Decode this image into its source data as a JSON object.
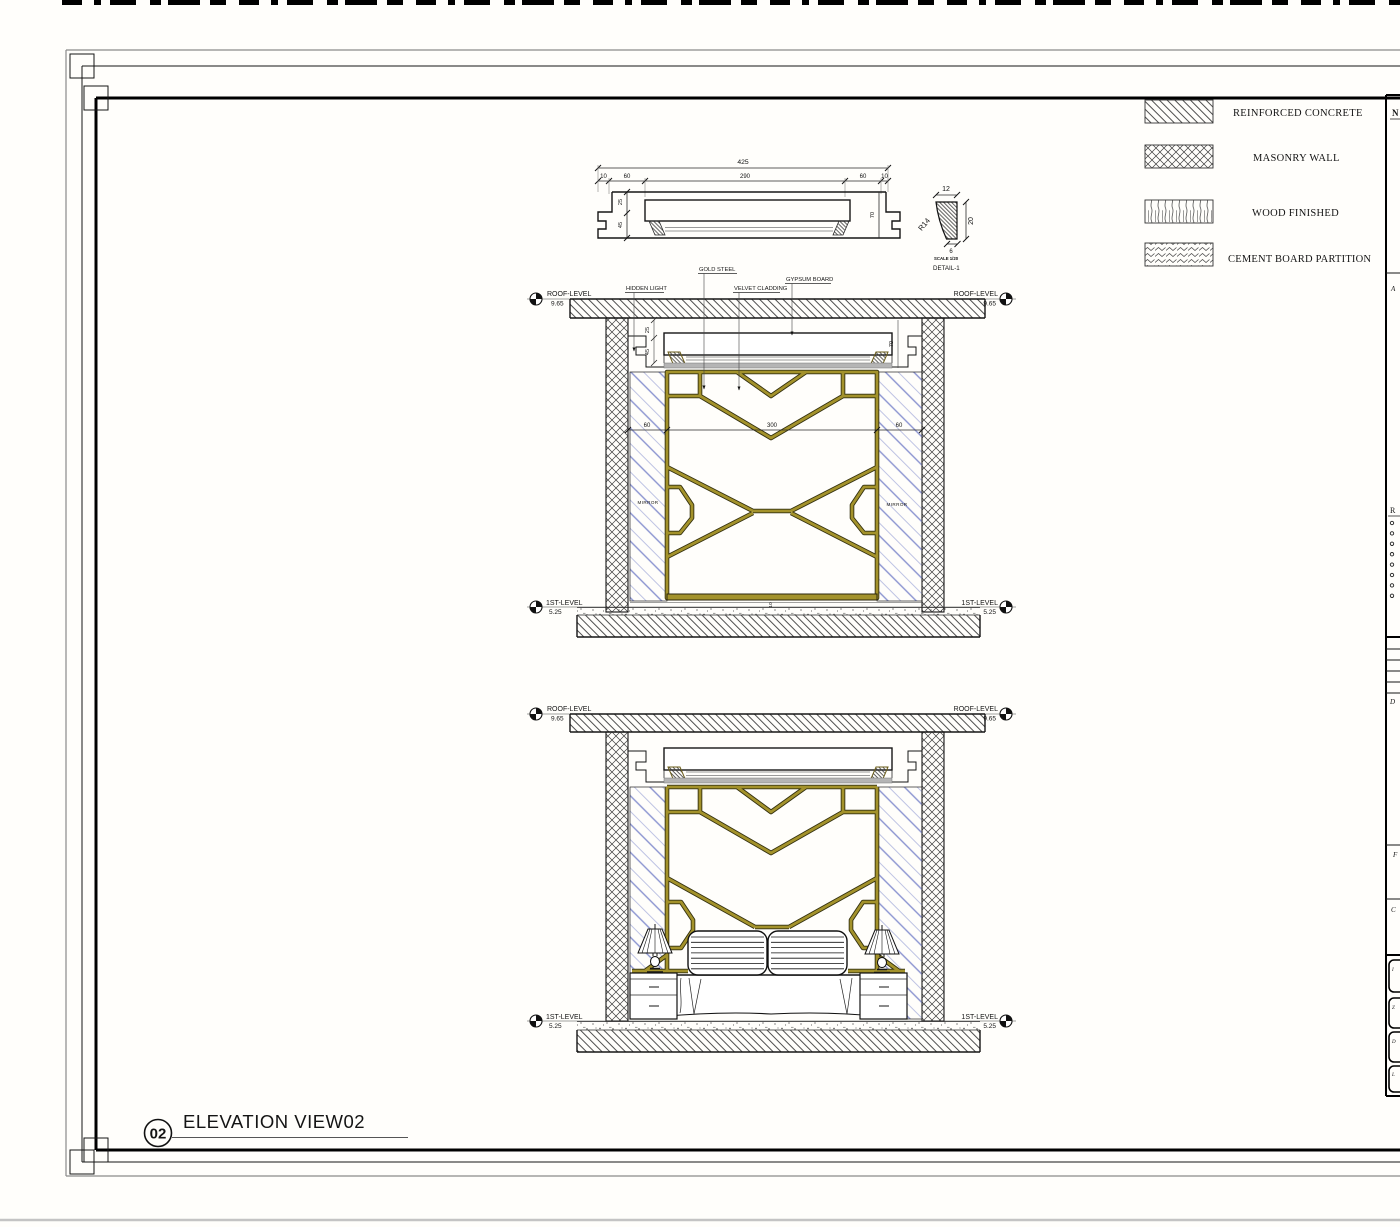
{
  "colors": {
    "gold": "#a3922b",
    "mirror_blue": "#8a93d0",
    "ink": "#141414"
  },
  "sheet": {
    "view_number": "02",
    "view_title": "ELEVATION VIEW02"
  },
  "legend": {
    "items": [
      {
        "name": "reinforced-concrete",
        "label": "REINFORCED CONCRETE"
      },
      {
        "name": "masonry-wall",
        "label": "MASONRY WALL"
      },
      {
        "name": "wood-finished",
        "label": "WOOD FINISHED"
      },
      {
        "name": "cement-board-partition",
        "label": "CEMENT BOARD PARTITION"
      }
    ]
  },
  "detail_section": {
    "dim_total": "425",
    "dim_segments": [
      "10",
      "60",
      "290",
      "60",
      "10"
    ],
    "dim_upper": "25",
    "dim_lower": "45",
    "dim_right": "70"
  },
  "detail_profile": {
    "dim_top": "12",
    "radius": "R14",
    "dim_side": "20",
    "dim_bottom": "6",
    "scale_note": "SCALE 1/20",
    "title": "DETAIL-1"
  },
  "annotations": {
    "hidden_light": "HIDDEN LIGHT",
    "gold_steel": "GOLD STEEL",
    "velvet_cladding": "VELVET CLADDING",
    "gypsum_board": "GYPSUM BOARD",
    "mirror": "MIRROR"
  },
  "levels": {
    "roof": {
      "label": "ROOF-LEVEL",
      "value": "9.65"
    },
    "first": {
      "label": "1ST-LEVEL",
      "value": "5.25"
    }
  },
  "elevation": {
    "dim_left": "60",
    "dim_center": "300",
    "dim_right": "60",
    "dim_ceiling_upper": "25",
    "dim_ceiling_lower": "45",
    "dim_ceiling_right": "70",
    "dim_floor": "10"
  },
  "side_panel": {
    "letters": {
      "n": "N",
      "a": "A",
      "r": "R",
      "d": "D",
      "f": "F",
      "c": "C"
    },
    "box_labels": [
      "I",
      "Z",
      "D",
      "L"
    ]
  }
}
